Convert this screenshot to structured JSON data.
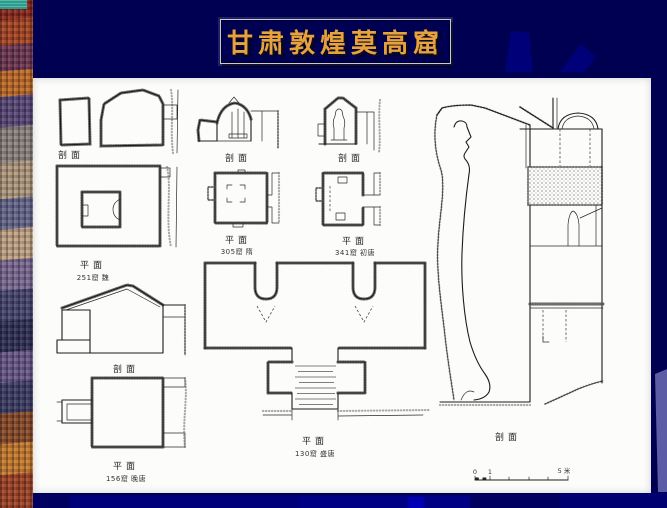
{
  "slide": {
    "title": "甘肃敦煌莫高窟",
    "colors": {
      "background": "#000052",
      "gear_shapes": "#000079",
      "right_accent_wedge": "#5b5ba6",
      "title_gold": "#e8a23c",
      "title_border": "#c8c8d2",
      "panel_paper": "#fcfcfa",
      "drawing_ink": "#1b1b1b",
      "left_strip_teal": "#2d9b8d"
    }
  },
  "figures": {
    "cave251": {
      "section_label": "剖面",
      "plan_label": "平面",
      "caption": "251窟  魏"
    },
    "cave305": {
      "section_label": "剖面",
      "plan_label": "平面",
      "caption": "305窟  隋"
    },
    "cave341": {
      "section_label": "剖面",
      "plan_label": "平面",
      "caption": "341窟  初唐"
    },
    "cave156": {
      "section_label": "剖面",
      "plan_label": "平面",
      "caption": "156窟  晚唐"
    },
    "cave130": {
      "plan_label": "平面",
      "plan_caption": "130窟  盛唐",
      "section_label": "剖面"
    },
    "scale_bar": {
      "zero": "0",
      "one": "1",
      "five": "5 米"
    }
  }
}
